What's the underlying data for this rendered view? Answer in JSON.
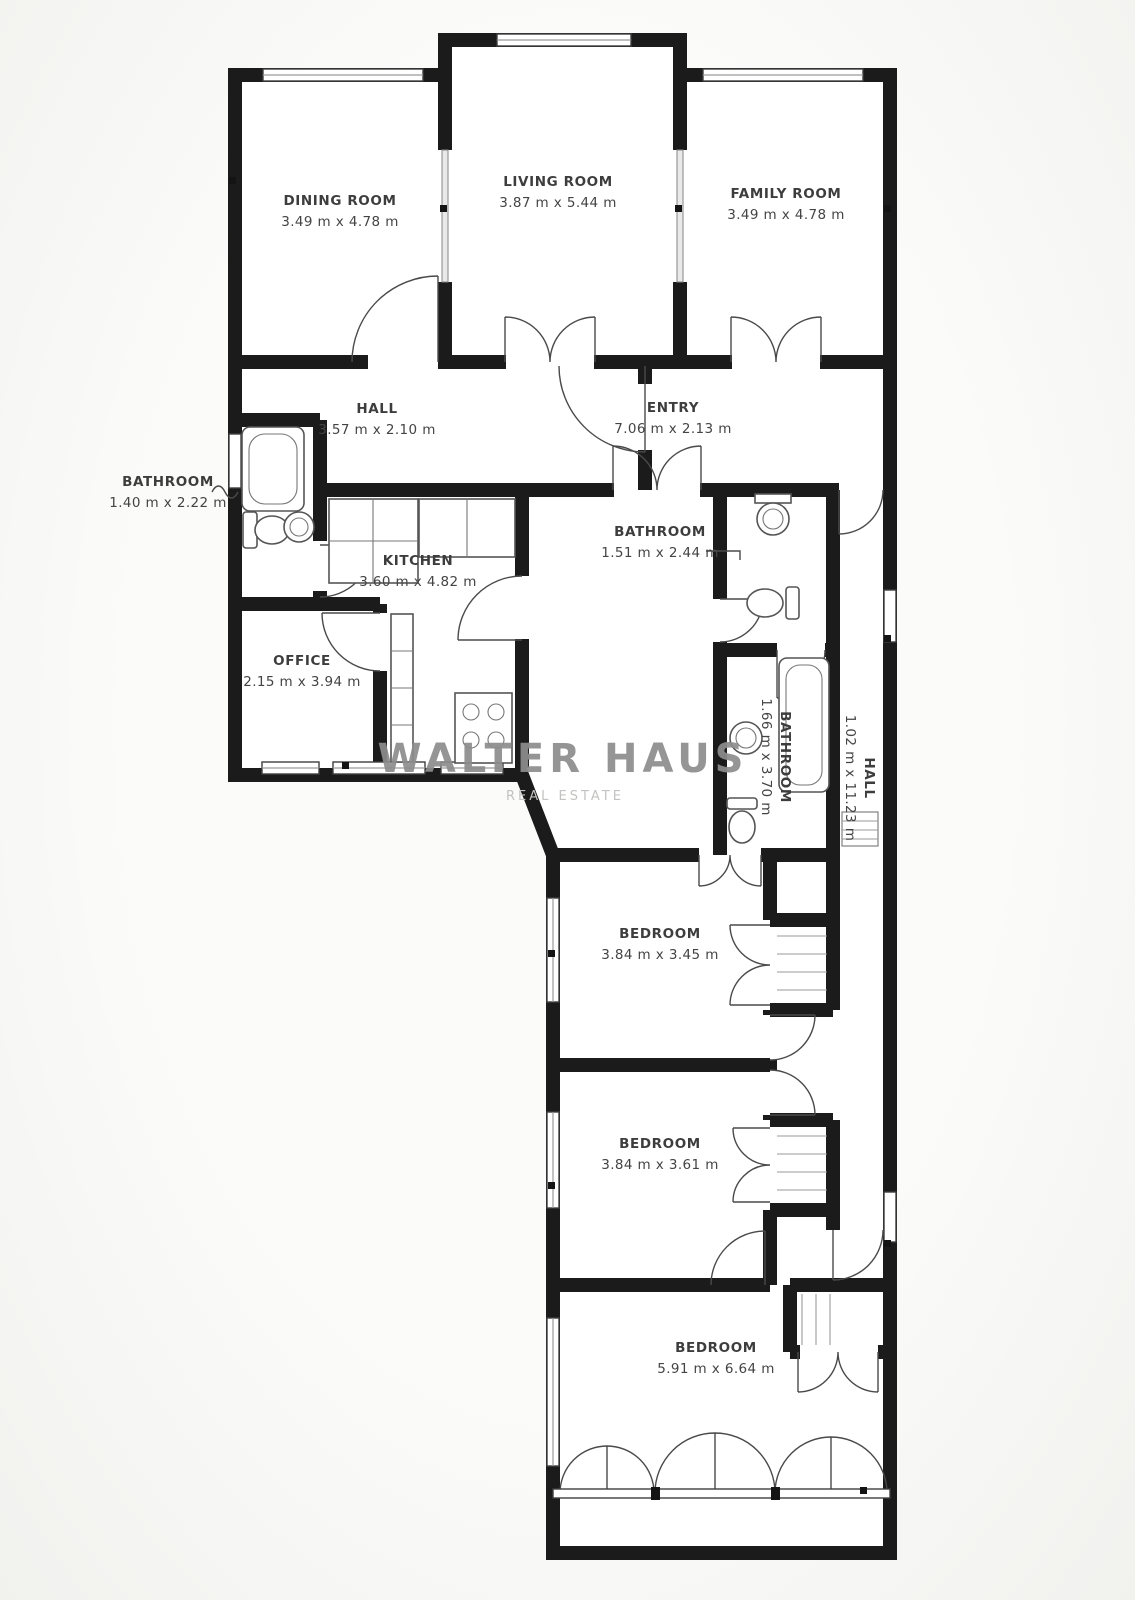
{
  "watermark": {
    "line1": "WALTER HAUS",
    "line2": "REAL ESTATE"
  },
  "rooms": {
    "dining": {
      "name": "DINING ROOM",
      "dims": "3.49 m x 4.78 m"
    },
    "living": {
      "name": "LIVING ROOM",
      "dims": "3.87 m x 5.44 m"
    },
    "family": {
      "name": "FAMILY ROOM",
      "dims": "3.49 m x 4.78 m"
    },
    "hall": {
      "name": "HALL",
      "dims": "3.57 m x 2.10 m"
    },
    "entry": {
      "name": "ENTRY",
      "dims": "7.06 m x 2.13 m"
    },
    "bathroom_left": {
      "name": "BATHROOM",
      "dims": "1.40 m x 2.22 m"
    },
    "kitchen": {
      "name": "KITCHEN",
      "dims": "3.60 m x 4.82 m"
    },
    "bathroom_middle": {
      "name": "BATHROOM",
      "dims": "1.51 m x 2.44 m"
    },
    "office": {
      "name": "OFFICE",
      "dims": "2.15 m x 3.94 m"
    },
    "bathroom_inner": {
      "name": "BATHROOM",
      "dims": "1.66 m x 3.70 m"
    },
    "hall_inner": {
      "name": "HALL",
      "dims": "1.02 m x 11.23 m"
    },
    "bedroom_top": {
      "name": "BEDROOM",
      "dims": "3.84 m x 3.45 m"
    },
    "bedroom_middle": {
      "name": "BEDROOM",
      "dims": "3.84 m x 3.61 m"
    },
    "bedroom_bottom": {
      "name": "BEDROOM",
      "dims": "5.91 m x 6.64 m"
    }
  },
  "colors": {
    "walls": "#1b1b1b",
    "background": "#fbfbfa",
    "watermark": "#8d8d8d",
    "watermark_sub": "#c3c3c1",
    "label_text": "#3d3d3d"
  }
}
